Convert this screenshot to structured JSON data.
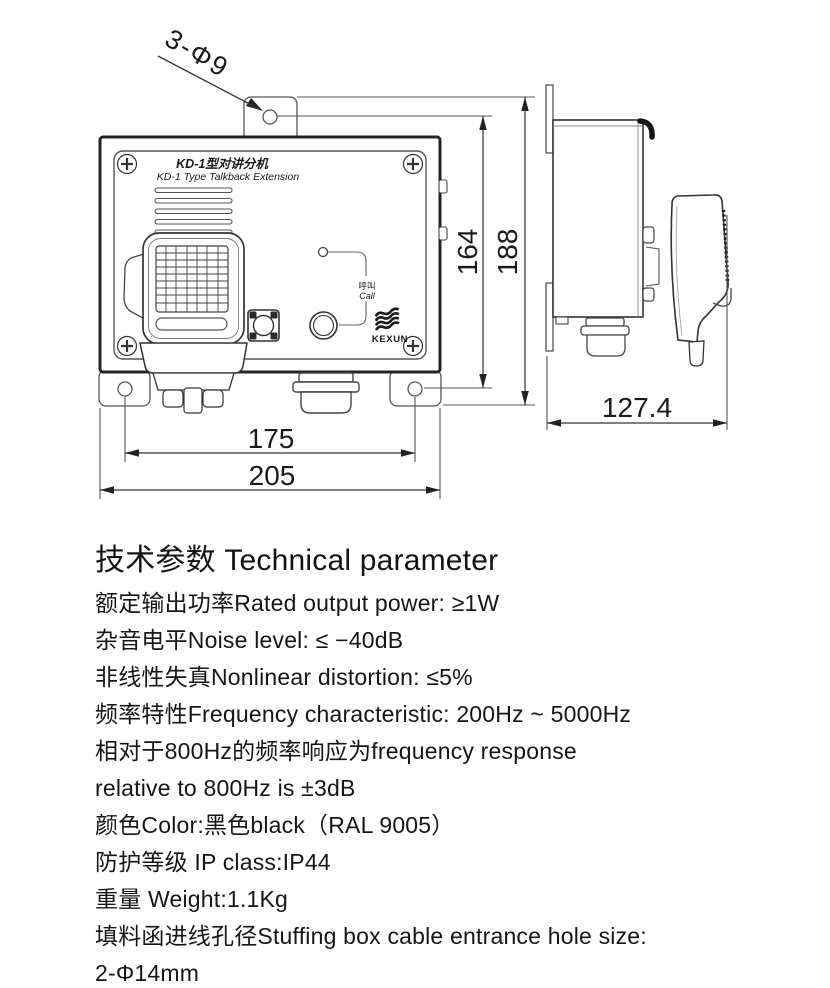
{
  "drawing": {
    "leader_label": "3-Φ9",
    "front": {
      "title_cn": "KD-1型对讲分机",
      "title_en": "KD-1 Type Talkback Extension",
      "call_label_cn": "呼叫",
      "call_label_en": "Call",
      "brand": "KEXUN"
    },
    "dims": {
      "height_inner": "164",
      "height_overall": "188",
      "width_holes": "175",
      "width_overall": "205",
      "depth": "127.4"
    }
  },
  "specs": {
    "heading": "技术参数 Technical parameter",
    "lines": [
      "额定输出功率Rated output power: ≥1W",
      "杂音电平Noise level: ≤ −40dB",
      "非线性失真Nonlinear distortion: ≤5%",
      "频率特性Frequency characteristic: 200Hz ~ 5000Hz",
      "相对于800Hz的频率响应为frequency response",
      "relative to 800Hz is ±3dB",
      "颜色Color:黑色black（RAL 9005）",
      "防护等级 IP class:IP44",
      "重量 Weight:1.1Kg",
      "填料函进线孔径Stuffing box cable entrance hole size:",
      "2-Φ14mm"
    ]
  }
}
